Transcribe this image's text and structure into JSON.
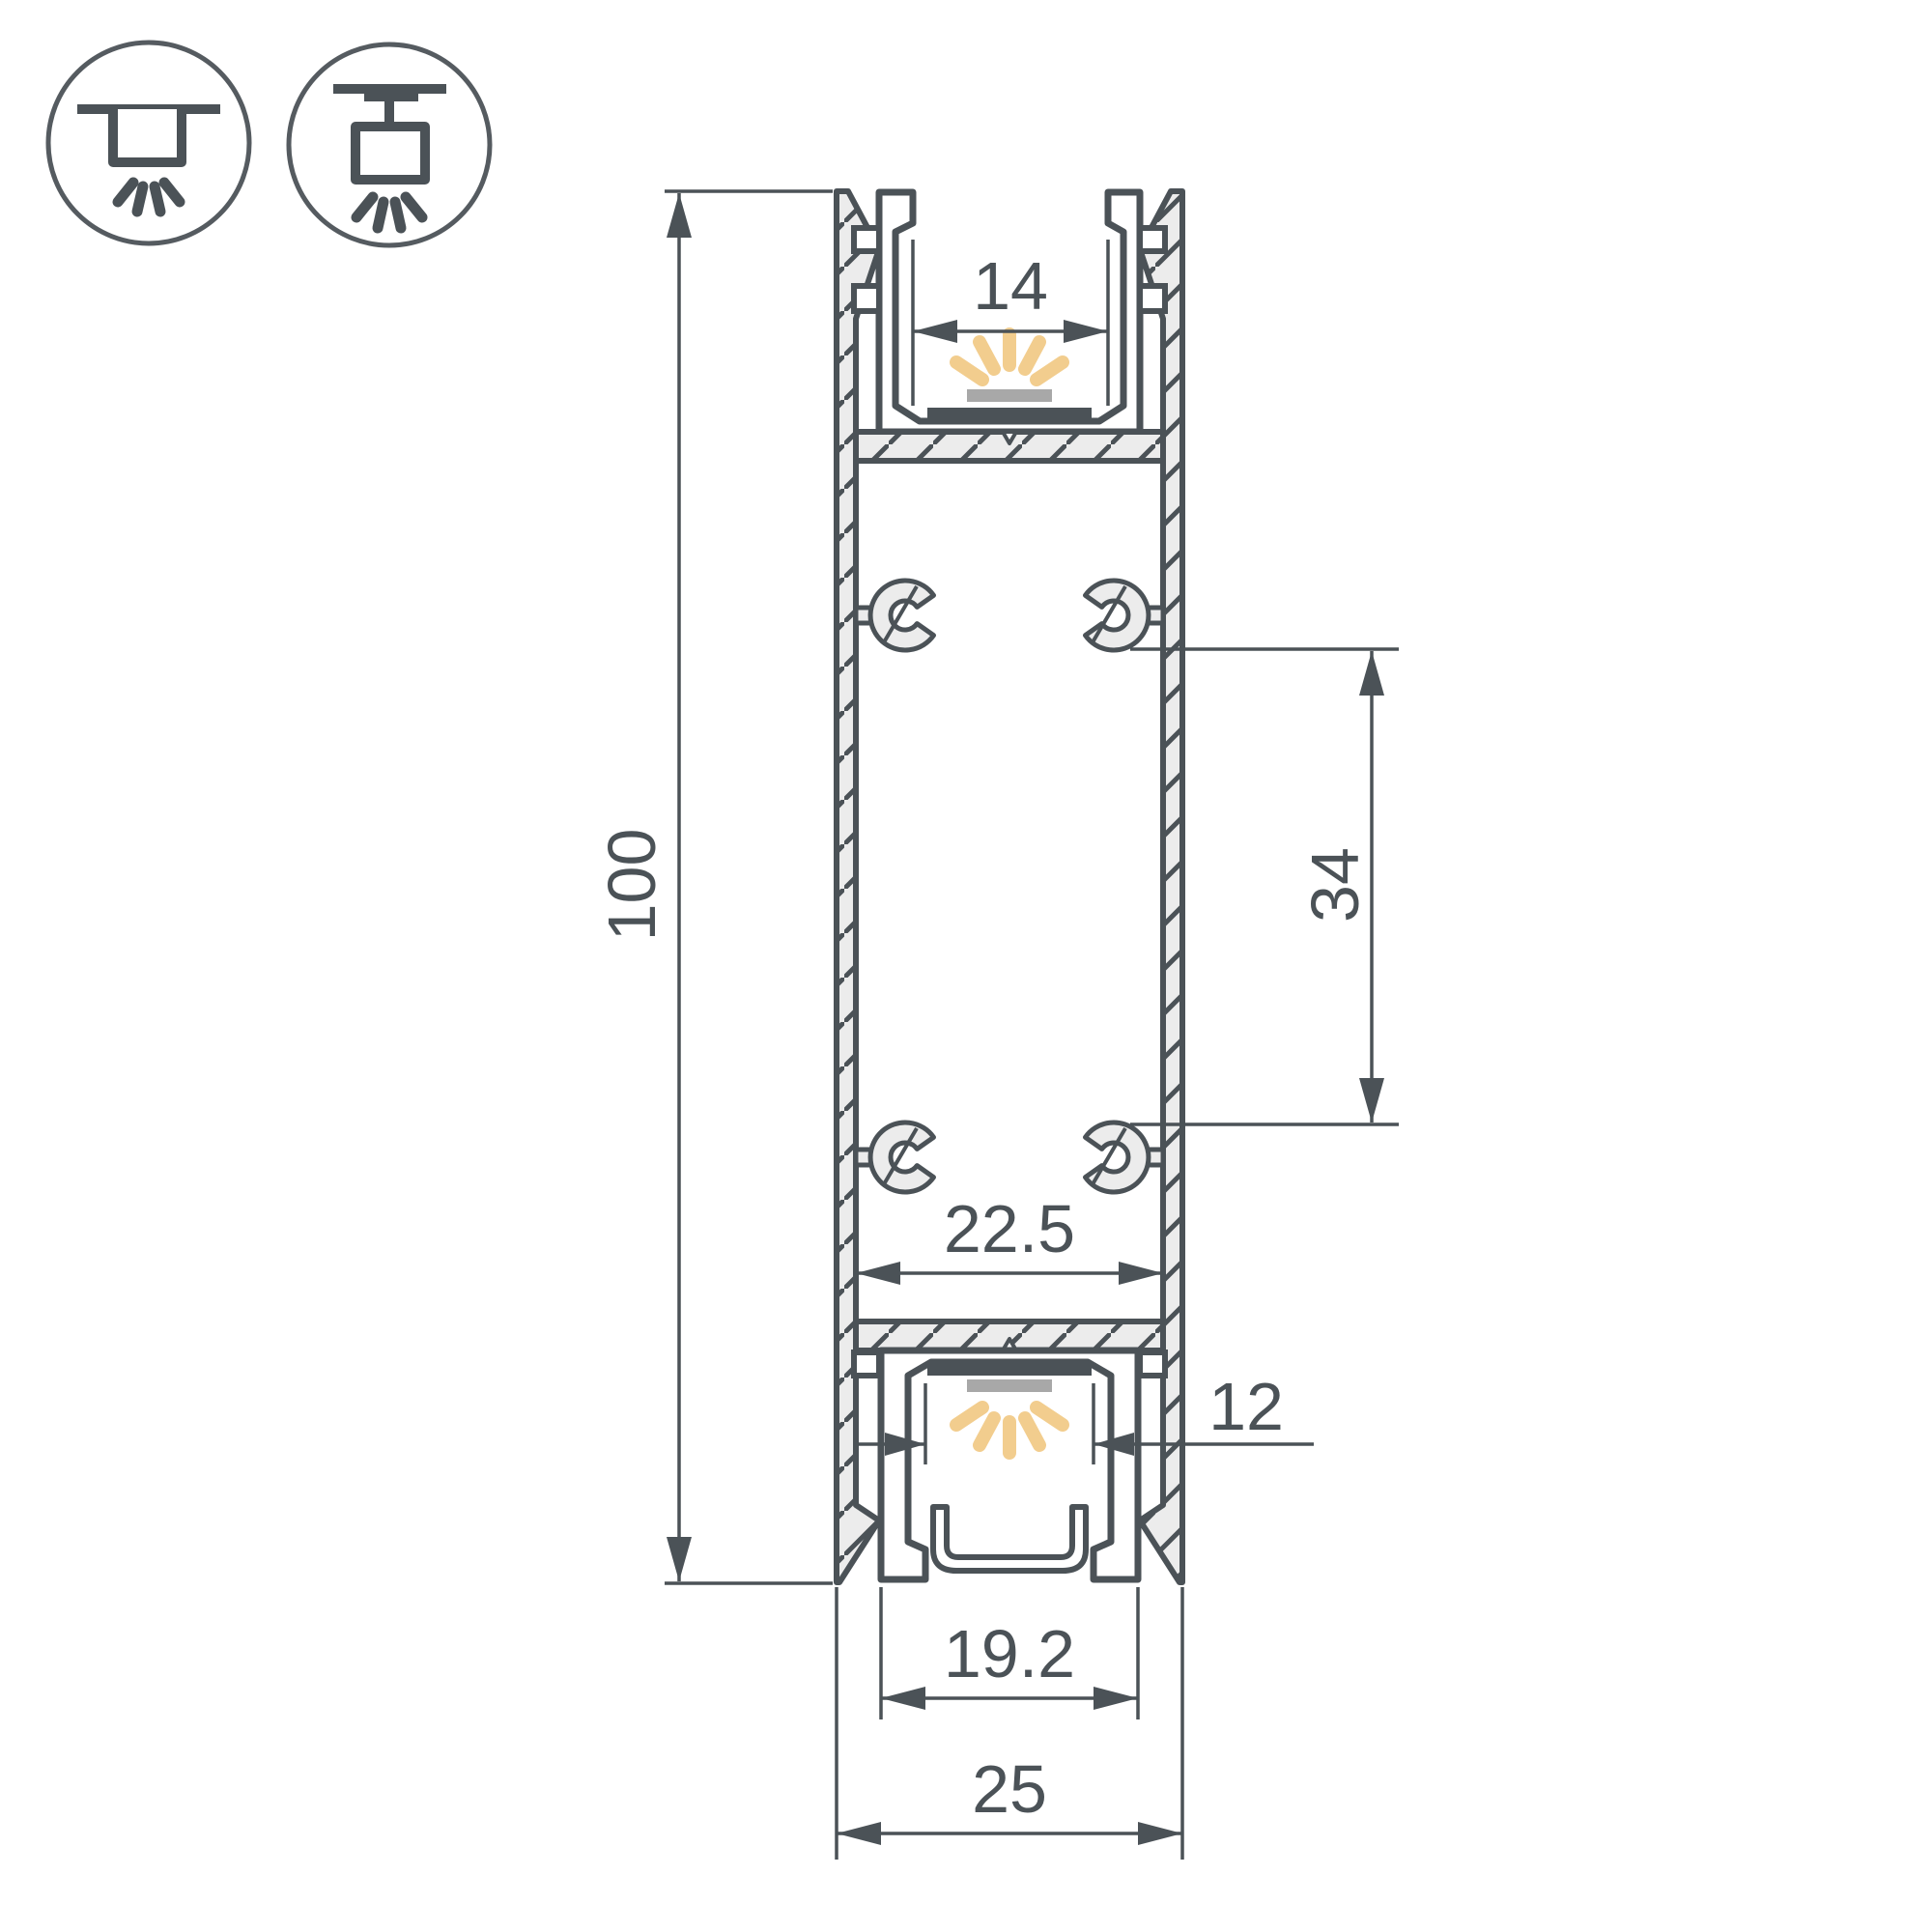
{
  "meta": {
    "drawing_type": "technical-cross-section",
    "subject": "Aluminium LED profile, double-sided (up/down light)"
  },
  "icons": {
    "recessed_mount": "recessed-ceiling-mount",
    "surface_mount": "surface-ceiling-mount"
  },
  "dimensions": {
    "overall_height": "100",
    "top_opening": "14",
    "screw_boss_spacing": "34",
    "inner_width": "22.5",
    "bottom_opening": "12",
    "bottom_channel_width": "19.2",
    "overall_width": "25"
  },
  "colors": {
    "line": "#4b5257",
    "aluminium_fill": "#ececec",
    "led_pcb": "#4b5257",
    "led_lens": "#a8a8a8",
    "light_rays": "#f2cd8e"
  }
}
